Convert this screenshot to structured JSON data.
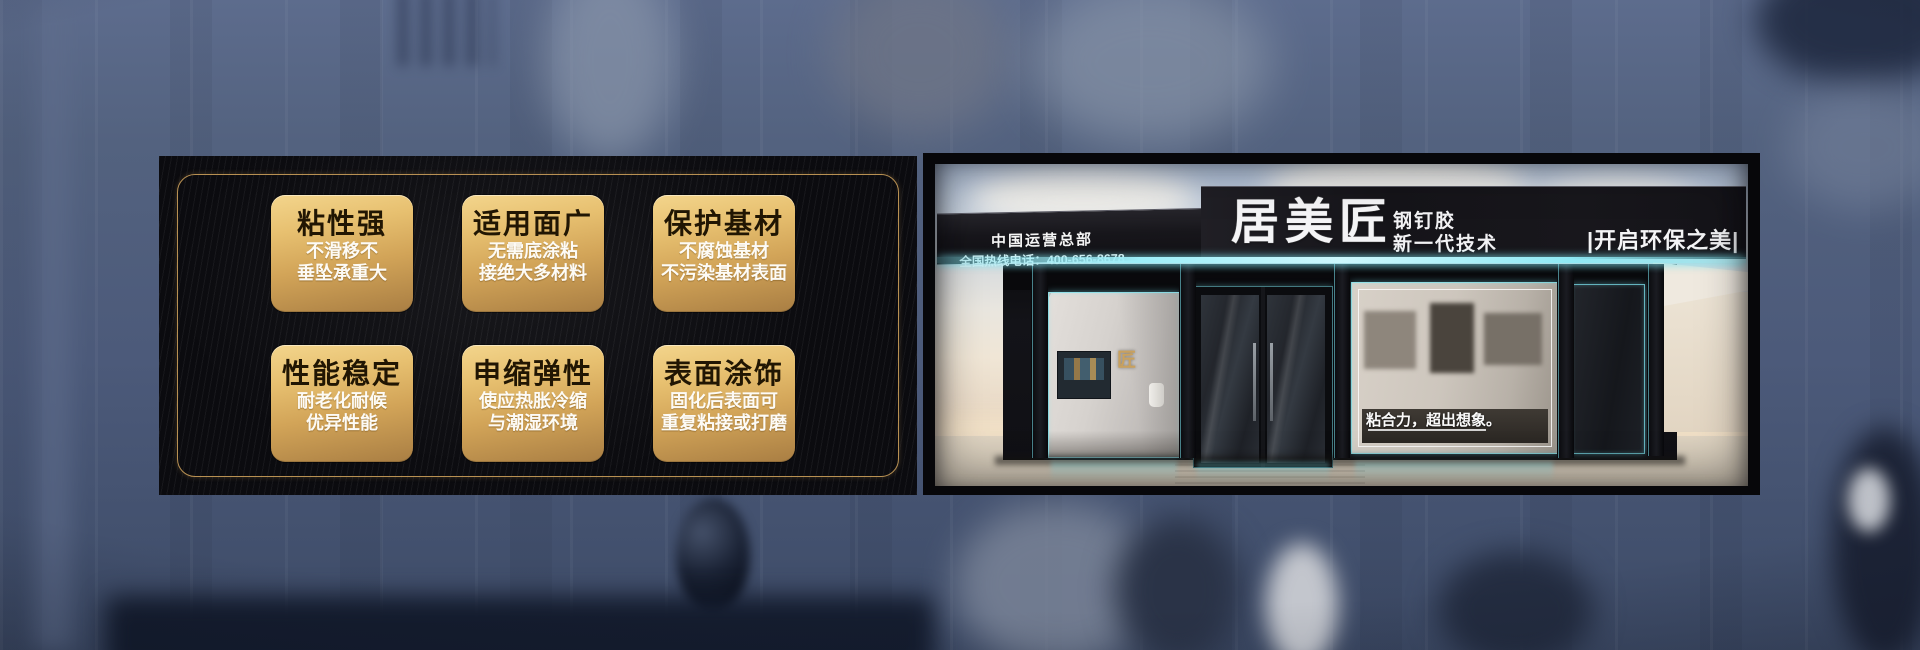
{
  "banner": {
    "features": {
      "cards": [
        {
          "title": "粘性强",
          "line1": "不滑移不",
          "line2": "垂坠承重大"
        },
        {
          "title": "适用面广",
          "line1": "无需底涂粘",
          "line2": "接绝大多材料"
        },
        {
          "title": "保护基材",
          "line1": "不腐蚀基材",
          "line2": "不污染基材表面"
        },
        {
          "title": "性能稳定",
          "line1": "耐老化耐候",
          "line2": "优异性能"
        },
        {
          "title": "申缩弹性",
          "line1": "使应热胀冷缩",
          "line2": "与潮湿环境"
        },
        {
          "title": "表面涂饰",
          "line1": "固化后表面可",
          "line2": "重复粘接或打磨"
        }
      ]
    },
    "storefront": {
      "hq_title": "中国运营总部",
      "hq_phone": "全国热线电话：400-656-8678",
      "brand": "居美匠",
      "product": "钢钉胶",
      "tech": "新一代技术",
      "eco_slogan": "|开启环保之美|",
      "window_slogan": "粘合力，超出想象。",
      "window_logo": "匠"
    },
    "colors": {
      "accent_gold": "#c79d5e",
      "card_gold_top": "#f3d58c",
      "card_gold_bottom": "#a97e43",
      "card_title_text": "#211603",
      "neon_cyan": "#7fe6f2",
      "panel_black": "#0b0b0f",
      "backdrop_slate": "#4d5b7c"
    }
  }
}
